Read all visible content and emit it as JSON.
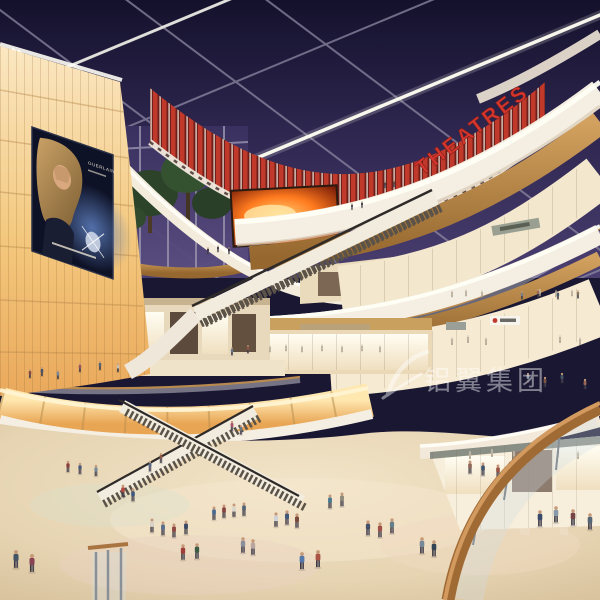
{
  "scene": {
    "description": "Multi-level shopping mall atrium interior rendering at dusk",
    "levels_visible": 4
  },
  "signs": {
    "theatres_label": "THEATRES",
    "billboard_brand": "GUERLAIN"
  },
  "watermark": {
    "text": "铝翼集团"
  },
  "colors": {
    "sky_top": "#14112c",
    "sky_bottom": "#4a3f70",
    "theatre_red": "#c0392b",
    "theatre_red_dark": "#6e1f1a",
    "fascia_cream": "#f5efe3",
    "fascia_glow": "#fffef6",
    "wood": "#c0914f",
    "wood_dark": "#96682f",
    "panel_amber": "#f0bd74",
    "storefront_warm": "#f6ead2",
    "floor_beige": "#e9d9bb",
    "billboard_bg": "#0e1226",
    "led_fire": "#ff7a1e"
  },
  "lights": [
    [
      90,
      58
    ],
    [
      160,
      114
    ],
    [
      234,
      56
    ],
    [
      304,
      118
    ],
    [
      370,
      60
    ],
    [
      438,
      20
    ],
    [
      516,
      10
    ],
    [
      262,
      18
    ],
    [
      36,
      18
    ],
    [
      554,
      58
    ],
    [
      488,
      306
    ],
    [
      518,
      300
    ],
    [
      545,
      173
    ],
    [
      356,
      160
    ],
    [
      243,
      316
    ],
    [
      93,
      335
    ],
    [
      450,
      296
    ],
    [
      575,
      428
    ]
  ],
  "people": [
    {
      "x": 68,
      "y": 462,
      "s": 0.7,
      "c": "#8a3d3a"
    },
    {
      "x": 80,
      "y": 464,
      "s": 0.7,
      "c": "#4a5a7a"
    },
    {
      "x": 96,
      "y": 466,
      "s": 0.7,
      "c": "#7a8a99"
    },
    {
      "x": 123,
      "y": 486,
      "s": 0.78,
      "c": "#b04a42"
    },
    {
      "x": 133,
      "y": 490,
      "s": 0.78,
      "c": "#3e567e"
    },
    {
      "x": 152,
      "y": 520,
      "s": 0.85,
      "c": "#d8d2c8"
    },
    {
      "x": 163,
      "y": 523,
      "s": 0.85,
      "c": "#5a6f8f"
    },
    {
      "x": 174,
      "y": 525,
      "s": 0.85,
      "c": "#8f4a44"
    },
    {
      "x": 186,
      "y": 522,
      "s": 0.85,
      "c": "#3a4a66"
    },
    {
      "x": 214,
      "y": 508,
      "s": 0.82,
      "c": "#4a6a8f"
    },
    {
      "x": 224,
      "y": 506,
      "s": 0.82,
      "c": "#884444"
    },
    {
      "x": 234,
      "y": 505,
      "s": 0.82,
      "c": "#dcd6ca"
    },
    {
      "x": 244,
      "y": 504,
      "s": 0.82,
      "c": "#556677"
    },
    {
      "x": 183,
      "y": 546,
      "s": 0.95,
      "c": "#a03f3a"
    },
    {
      "x": 197,
      "y": 545,
      "s": 0.95,
      "c": "#3d5c44"
    },
    {
      "x": 243,
      "y": 539,
      "s": 0.95,
      "c": "#8a8f99"
    },
    {
      "x": 253,
      "y": 541,
      "s": 0.95,
      "c": "#b9a5a0"
    },
    {
      "x": 276,
      "y": 514,
      "s": 0.88,
      "c": "#cfd3d8"
    },
    {
      "x": 287,
      "y": 512,
      "s": 0.88,
      "c": "#44597a"
    },
    {
      "x": 297,
      "y": 515,
      "s": 0.88,
      "c": "#7a4a3f"
    },
    {
      "x": 330,
      "y": 496,
      "s": 0.85,
      "c": "#4a7a8f"
    },
    {
      "x": 342,
      "y": 494,
      "s": 0.85,
      "c": "#8f8a7a"
    },
    {
      "x": 368,
      "y": 522,
      "s": 0.92,
      "c": "#44506a"
    },
    {
      "x": 380,
      "y": 524,
      "s": 0.92,
      "c": "#a05048"
    },
    {
      "x": 392,
      "y": 520,
      "s": 0.92,
      "c": "#66808a"
    },
    {
      "x": 302,
      "y": 554,
      "s": 1.05,
      "c": "#5577aa"
    },
    {
      "x": 318,
      "y": 552,
      "s": 1.05,
      "c": "#aa5544"
    },
    {
      "x": 422,
      "y": 539,
      "s": 1.0,
      "c": "#778899"
    },
    {
      "x": 434,
      "y": 542,
      "s": 1.0,
      "c": "#334455"
    },
    {
      "x": 16,
      "y": 552,
      "s": 1.1,
      "c": "#445566"
    },
    {
      "x": 32,
      "y": 556,
      "s": 1.1,
      "c": "#884455"
    },
    {
      "x": 470,
      "y": 462,
      "s": 0.8,
      "c": "#8f6a5a"
    },
    {
      "x": 483,
      "y": 464,
      "s": 0.8,
      "c": "#44556a"
    },
    {
      "x": 498,
      "y": 466,
      "s": 0.8,
      "c": "#995544"
    },
    {
      "x": 511,
      "y": 464,
      "s": 0.8,
      "c": "#667788"
    },
    {
      "x": 540,
      "y": 512,
      "s": 1.0,
      "c": "#3a4a6a"
    },
    {
      "x": 556,
      "y": 508,
      "s": 1.0,
      "c": "#8899aa"
    },
    {
      "x": 573,
      "y": 511,
      "s": 1.0,
      "c": "#774444"
    },
    {
      "x": 590,
      "y": 515,
      "s": 1.0,
      "c": "#556677"
    },
    {
      "x": 528,
      "y": 374,
      "s": 0.6,
      "c": "#8a99aa"
    },
    {
      "x": 545,
      "y": 378,
      "s": 0.62,
      "c": "#7a5544"
    },
    {
      "x": 562,
      "y": 374,
      "s": 0.62,
      "c": "#445566"
    },
    {
      "x": 585,
      "y": 380,
      "s": 0.62,
      "c": "#996655"
    },
    {
      "x": 522,
      "y": 292,
      "s": 0.5,
      "c": "#77808a"
    },
    {
      "x": 538,
      "y": 290,
      "s": 0.5,
      "c": "#996655"
    },
    {
      "x": 558,
      "y": 292,
      "s": 0.5,
      "c": "#44566a"
    },
    {
      "x": 578,
      "y": 291,
      "s": 0.5,
      "c": "#887766"
    },
    {
      "x": 30,
      "y": 370,
      "s": 0.55,
      "c": "#8a4a44"
    },
    {
      "x": 42,
      "y": 368,
      "s": 0.55,
      "c": "#44566e"
    },
    {
      "x": 58,
      "y": 371,
      "s": 0.55,
      "c": "#778a99"
    },
    {
      "x": 80,
      "y": 364,
      "s": 0.55,
      "c": "#995555"
    },
    {
      "x": 100,
      "y": 362,
      "s": 0.55,
      "c": "#556677"
    },
    {
      "x": 118,
      "y": 364,
      "s": 0.55,
      "c": "#cabfae"
    },
    {
      "x": 232,
      "y": 348,
      "s": 0.5,
      "c": "#667788"
    },
    {
      "x": 248,
      "y": 346,
      "s": 0.5,
      "c": "#885544"
    },
    {
      "x": 150,
      "y": 462,
      "s": 0.65,
      "c": "#5a6a8a"
    },
    {
      "x": 161,
      "y": 454,
      "s": 0.62,
      "c": "#8a5a4a"
    },
    {
      "x": 232,
      "y": 422,
      "s": 0.62,
      "c": "#aa5566"
    },
    {
      "x": 241,
      "y": 426,
      "s": 0.6,
      "c": "#667788"
    },
    {
      "x": 208,
      "y": 248,
      "s": 0.42,
      "c": "#3a3440"
    },
    {
      "x": 218,
      "y": 246,
      "s": 0.42,
      "c": "#46404c"
    },
    {
      "x": 229,
      "y": 248,
      "s": 0.42,
      "c": "#3a3440"
    },
    {
      "x": 352,
      "y": 204,
      "s": 0.4,
      "c": "#44404a"
    },
    {
      "x": 362,
      "y": 202,
      "s": 0.4,
      "c": "#38343e"
    },
    {
      "x": 385,
      "y": 182,
      "s": 0.42,
      "c": "#4a4450"
    },
    {
      "x": 394,
      "y": 181,
      "s": 0.42,
      "c": "#5c4a4a"
    }
  ],
  "mannequins": [
    {
      "x": 452,
      "y": 291,
      "s": 0.45
    },
    {
      "x": 466,
      "y": 290,
      "s": 0.45
    },
    {
      "x": 482,
      "y": 291,
      "s": 0.45
    },
    {
      "x": 540,
      "y": 290,
      "s": 0.45
    },
    {
      "x": 556,
      "y": 291,
      "s": 0.45
    },
    {
      "x": 572,
      "y": 290,
      "s": 0.45
    },
    {
      "x": 270,
      "y": 346,
      "s": 0.45
    },
    {
      "x": 286,
      "y": 345,
      "s": 0.45
    },
    {
      "x": 302,
      "y": 346,
      "s": 0.45
    },
    {
      "x": 322,
      "y": 345,
      "s": 0.45
    },
    {
      "x": 342,
      "y": 346,
      "s": 0.45
    },
    {
      "x": 362,
      "y": 345,
      "s": 0.45
    },
    {
      "x": 380,
      "y": 346,
      "s": 0.45
    },
    {
      "x": 452,
      "y": 338,
      "s": 0.5
    },
    {
      "x": 468,
      "y": 336,
      "s": 0.5
    },
    {
      "x": 486,
      "y": 338,
      "s": 0.5
    },
    {
      "x": 560,
      "y": 336,
      "s": 0.5
    },
    {
      "x": 580,
      "y": 338,
      "s": 0.5
    },
    {
      "x": 470,
      "y": 452,
      "s": 0.5
    },
    {
      "x": 492,
      "y": 450,
      "s": 0.5
    },
    {
      "x": 514,
      "y": 452,
      "s": 0.5
    },
    {
      "x": 558,
      "y": 450,
      "s": 0.5
    },
    {
      "x": 578,
      "y": 452,
      "s": 0.5
    }
  ]
}
